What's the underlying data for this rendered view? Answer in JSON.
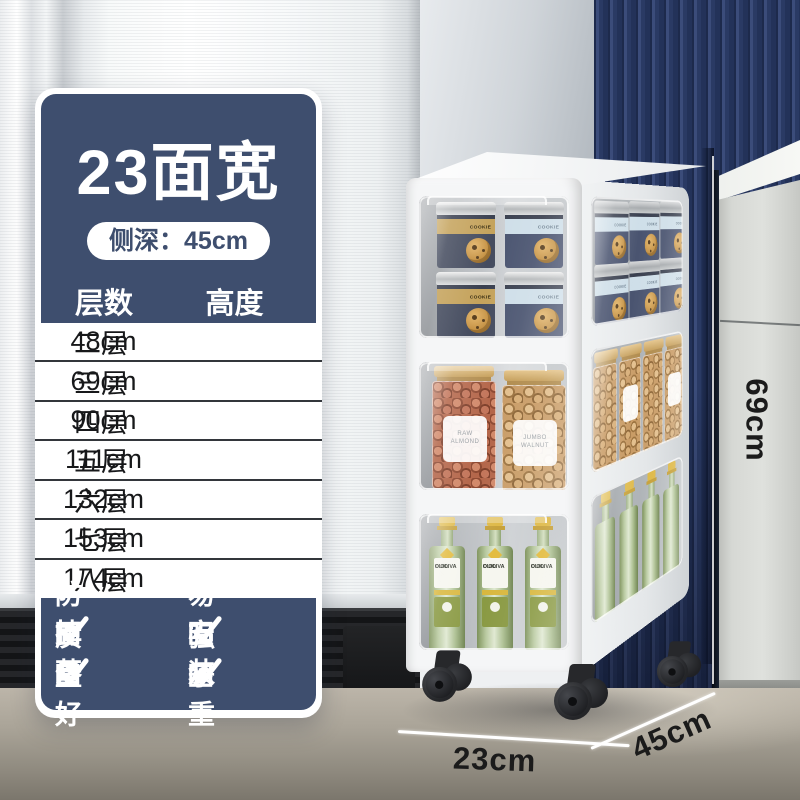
{
  "panel": {
    "title": "23面宽",
    "depth_badge": "侧深：45cm",
    "table": {
      "col_layers": "层数",
      "col_height": "高度",
      "rows": [
        {
          "layers": "二层",
          "height": "48cm"
        },
        {
          "layers": "三层",
          "height": "69cm"
        },
        {
          "layers": "四层",
          "height": "90cm"
        },
        {
          "layers": "五层",
          "height": "111cm"
        },
        {
          "layers": "六层",
          "height": "132cm"
        },
        {
          "layers": "七层",
          "height": "153cm"
        },
        {
          "layers": "八层",
          "height": "174cm"
        }
      ]
    },
    "features": [
      {
        "label": "防掉落"
      },
      {
        "label": "易安装"
      },
      {
        "label": "质量好"
      },
      {
        "label": "强承重"
      }
    ]
  },
  "dimensions": {
    "height_label": "69cm",
    "width_label": "23cm",
    "depth_label": "45cm"
  },
  "jars": {
    "cookie": "COOKIE MIX",
    "almond_line1": "RAW",
    "almond_line2": "ALMOND",
    "walnut_line1": "JUMBO",
    "walnut_line2": "WALNUT",
    "oil_line1": "OLIO",
    "oil_line2": "D'OLIVA"
  },
  "colors": {
    "panel_navy": "#3e4e6e",
    "wall_blue": "#2a3a64",
    "floor": "#aaa498",
    "cart_white": "#f5f6f7"
  }
}
